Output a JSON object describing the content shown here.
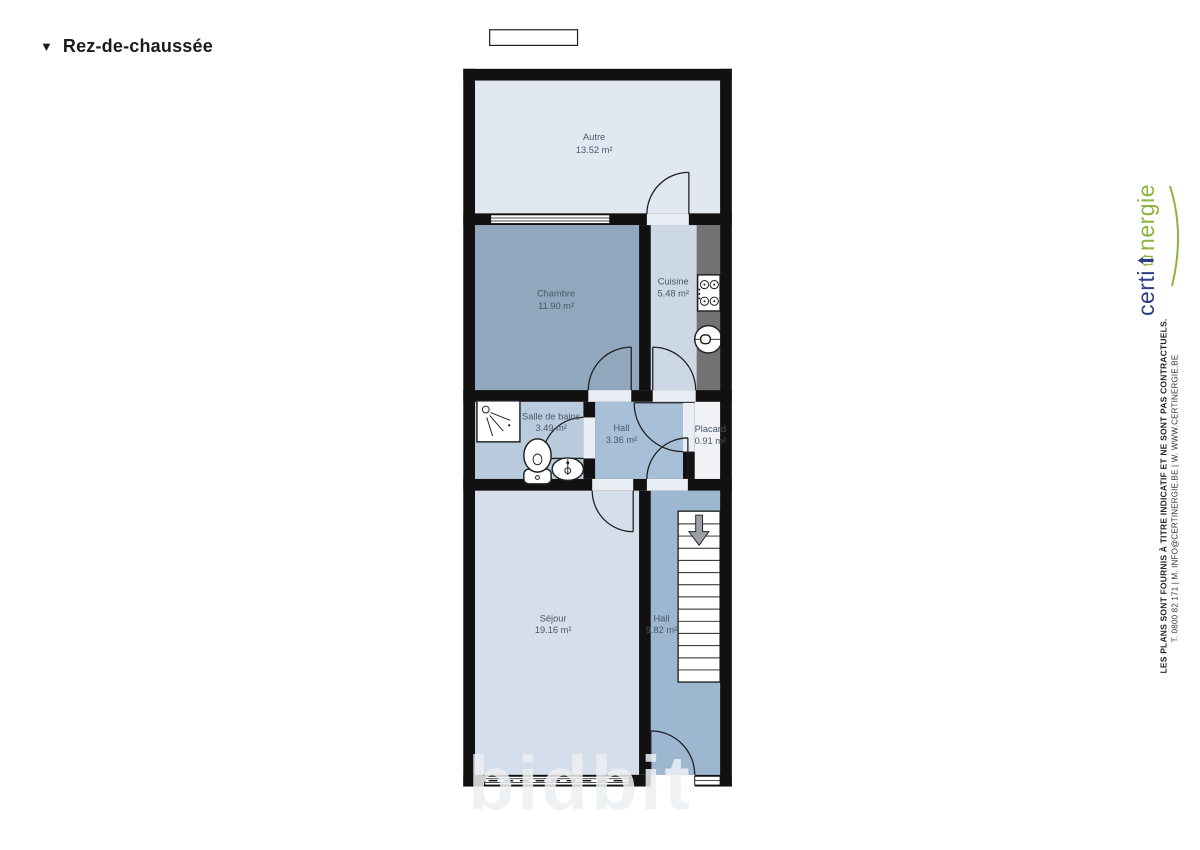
{
  "header": {
    "collapse_icon": "▼",
    "title": "Rez-de-chaussée"
  },
  "floorplan": {
    "wall_color": "#111111",
    "counter_color": "#727272",
    "door_opening_color": "#e9eef5",
    "watermark": "bidbit",
    "rooms": [
      {
        "id": "autre",
        "name": "Autre",
        "area": "13.52 m²",
        "fill": "#e2e8f2"
      },
      {
        "id": "chambre",
        "name": "Chambre",
        "area": "11.90 m²",
        "fill": "#90a7bd"
      },
      {
        "id": "cuisine",
        "name": "Cuisine",
        "area": "5.48 m²",
        "fill": "#ccd8e4"
      },
      {
        "id": "salle-de-bains",
        "name": "Salle de bains",
        "area": "3.49 m²",
        "fill": "#b9cbdc"
      },
      {
        "id": "hall",
        "name": "Hall",
        "area": "3.36 m²",
        "fill": "#a7bfd7"
      },
      {
        "id": "placard",
        "name": "Placard",
        "area": "0.91 m²",
        "fill": "#f0f2f6"
      },
      {
        "id": "sejour",
        "name": "Séjour",
        "area": "19.16 m²",
        "fill": "#d5dfeb"
      },
      {
        "id": "hall-escalier",
        "name": "Hall",
        "area": "9.82 m²",
        "fill": "#9db7d1"
      }
    ]
  },
  "branding": {
    "logo_certi": "certi",
    "logo_nergie": "nergie",
    "certi_color": "#2c3e85",
    "nergie_color": "#8cb43e"
  },
  "disclaimer": {
    "line1": "LES PLANS SONT FOURNIS À TITRE INDICATIF ET NE SONT PAS CONTRACTUELS.",
    "line2": "T. 0800 82 171 | M. INFO@CERTINERGIE.BE | W. WWW.CERTINERGIE.BE"
  }
}
